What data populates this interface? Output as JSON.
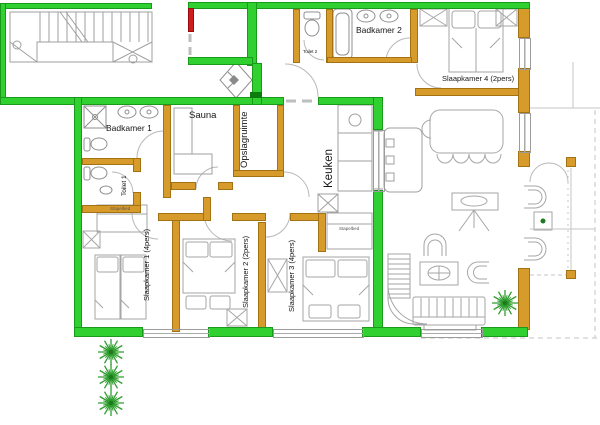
{
  "floorplan": {
    "rooms": {
      "badkamer1": "Badkamer 1",
      "toilet1": "Toilet 1",
      "sauna": "Sauna",
      "opslagruimte": "Opslagruimte",
      "keuken": "Keuken",
      "badkamer2": "Badkamer 2",
      "toilet2": "Toilet 2",
      "slaapkamer1": "Slaapkamer 1 (4pers)",
      "slaapkamer2": "Slaapkamer 2 (2pers)",
      "slaapkamer3": "Slaapkamer 3 (4pers)",
      "slaapkamer4": "Slaapkamer 4 (2pers)"
    },
    "furniture_annotations": {
      "stapelbed": "Stapelbed"
    },
    "colors": {
      "exterior_wall": "#2fd02f",
      "interior_wall": "#d79b2c",
      "accent_red": "#cf1c1c",
      "furniture_line": "#a6a6a6",
      "plant_green": "#2f9e2f"
    }
  }
}
